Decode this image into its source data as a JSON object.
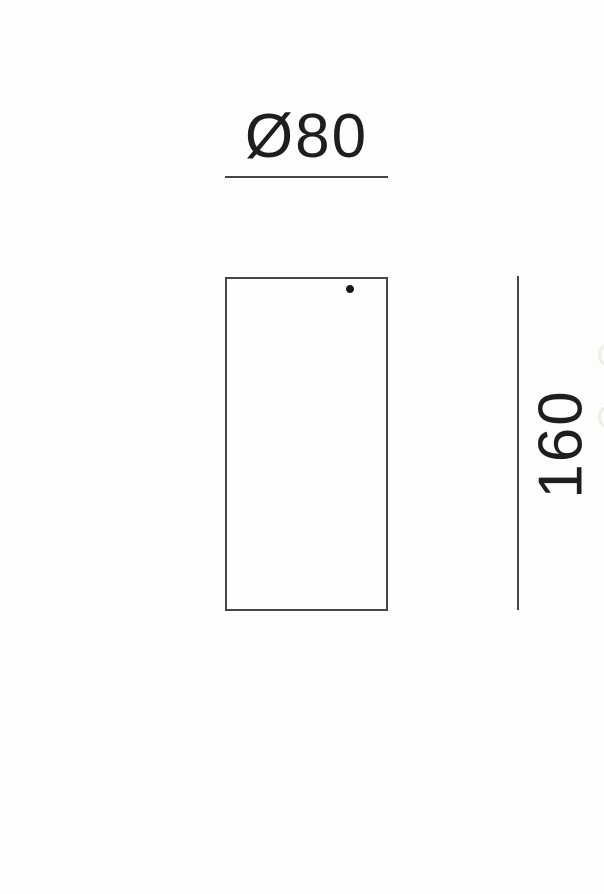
{
  "drawing": {
    "type": "technical-dimension-drawing",
    "subject": "cylindrical surface-mounted fixture, front elevation",
    "diameter_label": "Ø80",
    "height_label": "160",
    "colors": {
      "background": "#fdfdfc",
      "line": "#454545",
      "text": "#1e1e1e",
      "dot": "#161616"
    }
  }
}
